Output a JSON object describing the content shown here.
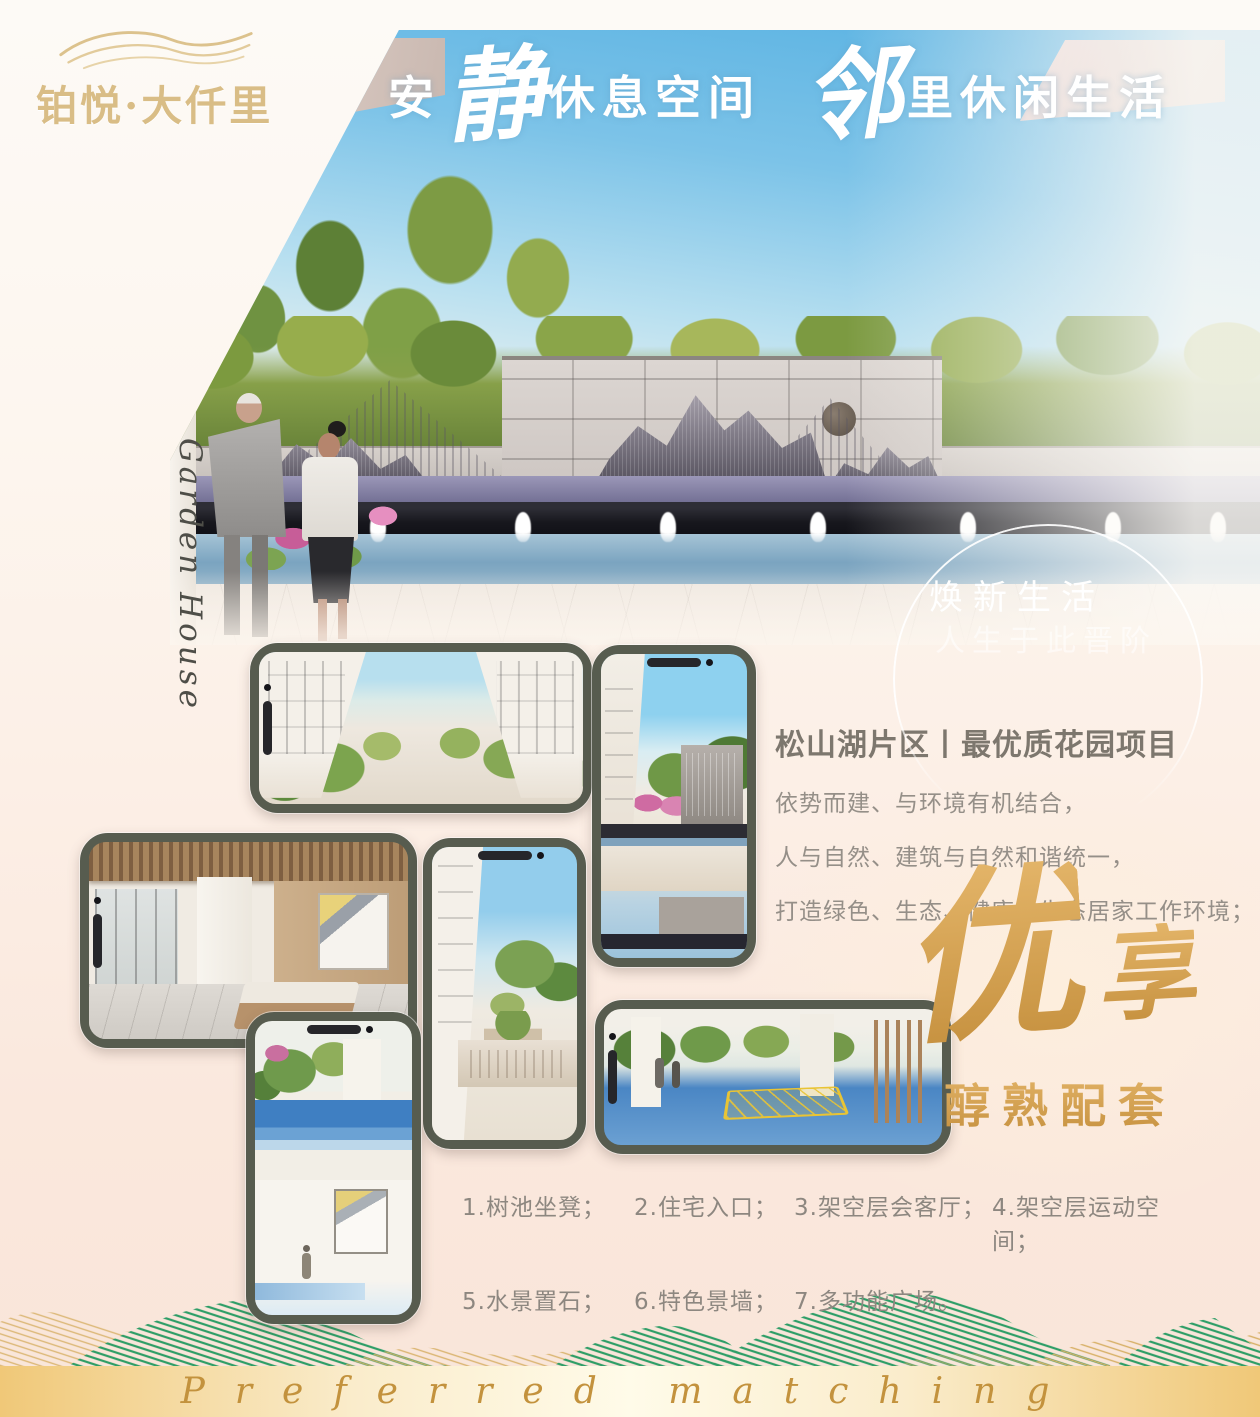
{
  "brand": {
    "name": "铂悦·大仟里",
    "icon": "wave-lines-icon"
  },
  "hero": {
    "heading": {
      "part1": "安",
      "big1": "静",
      "part2": "休息空间",
      "big2": "邻",
      "part3": "里休闲生活"
    },
    "slogan_line1": "焕新生活",
    "slogan_line2": "人生于此晋阶",
    "side_script": "Garden House"
  },
  "intro": {
    "title": "松山湖片区丨最优质花园项目",
    "lines": [
      "依势而建、与环境有机结合，",
      "人与自然、建筑与自然和谐统一，",
      "打造绿色、生态、健康的生态居家工作环境；"
    ]
  },
  "highlight": {
    "big": "优",
    "small": "享",
    "subtitle": "醇熟配套"
  },
  "features": {
    "items": [
      "1.树池坐凳；",
      "2.住宅入口；",
      "3.架空层会客厅；",
      "4.架空层运动空间；",
      "5.水景置石；",
      "6.特色景墙；",
      "7.多功能广场。"
    ]
  },
  "footer": {
    "script_text": "Preferred matching"
  },
  "phones": [
    {
      "scene": "residential-street-render"
    },
    {
      "scene": "water-feature-wall-render"
    },
    {
      "scene": "stilt-floor-lounge-render"
    },
    {
      "scene": "residence-entrance-render"
    },
    {
      "scene": "tree-pool-playground-render"
    },
    {
      "scene": "multifunction-plaza-render"
    }
  ],
  "colors": {
    "accent_gold": "#d2a253",
    "deep_gold": "#c3923d",
    "phone_frame": "#575c4f",
    "title_gray": "#7d776e",
    "text_gray": "#8f8982",
    "wave_green": "#2e9e67",
    "wave_gold": "#d7b066"
  }
}
